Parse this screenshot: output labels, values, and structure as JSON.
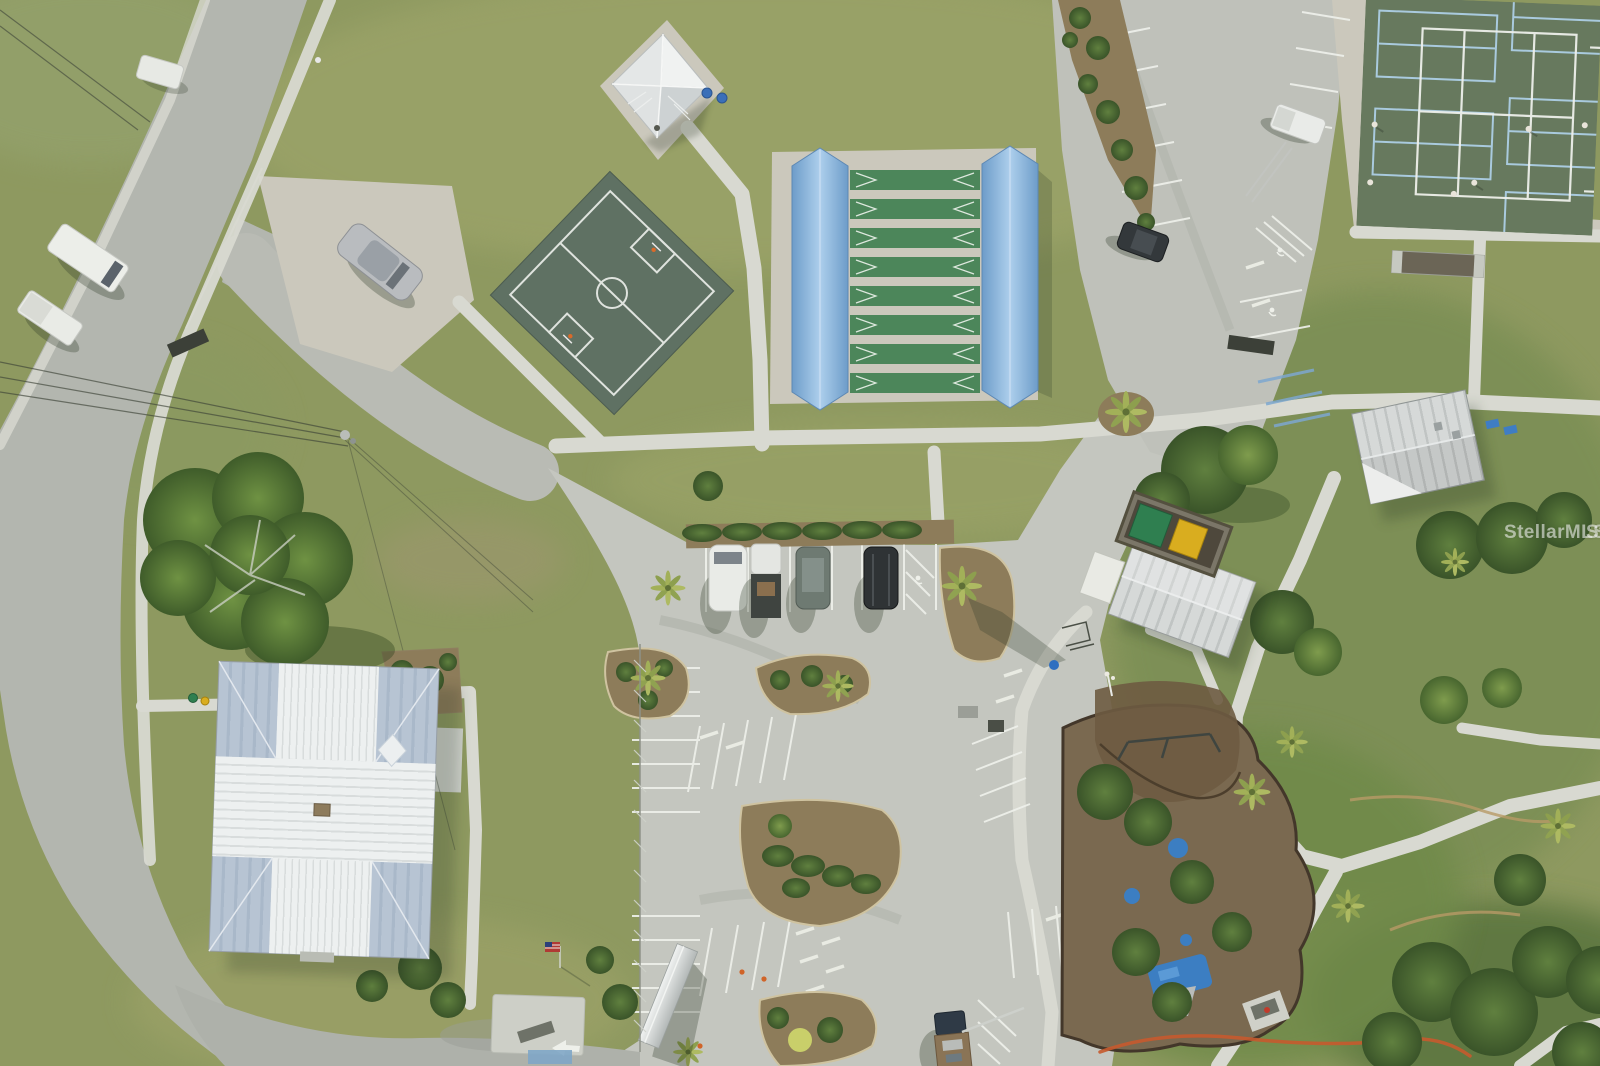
{
  "image": {
    "kind": "aerial-drone-photo",
    "subject": "community park campus with courts, parking and playground",
    "width_px": 1600,
    "height_px": 1066
  },
  "watermark": {
    "text": "StellarMLS"
  },
  "palette": {
    "grass-base": "#8e9960",
    "grass-light": "#9aa268",
    "grass-dark": "#7b8f54",
    "grass-deep": "#55713b",
    "road": "#b3b6af",
    "plaza": "#c4c6bf",
    "lot": "#bfc1ba",
    "walk": "#d8d9d1",
    "pad": "#cbc8bc",
    "white-line": "#eef0ea",
    "handicap-blue": "#7da7cf",
    "court-surface": "#5f7163",
    "court-line": "#dfe3de",
    "shuffle-green": "#4c865a",
    "canopy-blue": "#84aed6",
    "tennis-green": "#67795e",
    "tennis-blue-line": "#a9cade",
    "roof-white": "#e7eaea",
    "roof-blue-gray": "#b7c4d3",
    "roof-metal": "#c9cccb",
    "mulch": "#8d7c5a",
    "mulch-dark": "#6e5b41",
    "bush": "#4e6f3a",
    "tree-dark": "#466533",
    "palm": "#a8b75f",
    "dumpster-green": "#2f7f50",
    "dumpster-yellow": "#d9ad1f",
    "play-blue": "#3c7ec2",
    "safety-orange": "#c75a2e",
    "watermark-color": "rgba(255,255,255,0.55)"
  },
  "scene": {
    "features": [
      {
        "id": "public-road",
        "label": "public road with sidewalk, northwest corner"
      },
      {
        "id": "driveway-apron",
        "label": "roadside concrete apron with parked silver car"
      },
      {
        "id": "picnic-pavilion",
        "label": "square picnic pavilion, pyramidal metal roof"
      },
      {
        "id": "basketball-court",
        "label": "dark green basketball court set diagonally"
      },
      {
        "id": "shuffleboard-complex",
        "label": "eight shuffleboard courts between two light-blue canopies"
      },
      {
        "id": "tennis-pickleball-courts",
        "label": "tennis / pickleball courts with players, top right"
      },
      {
        "id": "north-parking-lot",
        "label": "striped parking lot, top right"
      },
      {
        "id": "community-building",
        "label": "community building with cross-shaped white metal roof"
      },
      {
        "id": "restroom-building",
        "label": "gable-roof park building"
      },
      {
        "id": "storage-shed",
        "label": "metal storage shed with porch pad"
      },
      {
        "id": "dumpster-enclosure",
        "label": "dumpster enclosure with green and yellow bins"
      },
      {
        "id": "central-parking",
        "label": "central parking plaza with landscaped islands"
      },
      {
        "id": "playground",
        "label": "playground with blue equipment on brown mulch"
      },
      {
        "id": "big-oak-tree",
        "label": "large spreading oak tree on lawn"
      },
      {
        "id": "palm-trees",
        "label": "cabbage palms along walks and islands"
      },
      {
        "id": "power-lines",
        "label": "overhead power lines with utility pole"
      },
      {
        "id": "orange-safety-fence",
        "label": "orange temporary safety fence near playground"
      },
      {
        "id": "us-flag",
        "label": "small United States flag near building"
      }
    ],
    "vehicles": [
      {
        "id": "silver-car",
        "color": "silver",
        "location": "driveway apron by road"
      },
      {
        "id": "white-van",
        "color": "white",
        "location": "west road shoulder"
      },
      {
        "id": "white-pickup",
        "color": "white",
        "location": "west road shoulder"
      },
      {
        "id": "white-suv",
        "color": "white",
        "location": "central parking row"
      },
      {
        "id": "white-truck-dark-bed",
        "color": "white cab, dark bed",
        "location": "central parking row"
      },
      {
        "id": "gray-suv",
        "color": "gray-green",
        "location": "central parking row"
      },
      {
        "id": "black-suv",
        "color": "black",
        "location": "central parking row"
      },
      {
        "id": "dark-suv",
        "color": "dark gray",
        "location": "north parking lot"
      },
      {
        "id": "white-utility-truck",
        "color": "white",
        "location": "north parking lot"
      },
      {
        "id": "flatbed-truck",
        "color": "dark cab, tan bed",
        "location": "south parking edge"
      }
    ],
    "counts": {
      "shuffleboard_courts": 8,
      "vehicles_center_row": 4,
      "tennis_players_visible": 6
    }
  }
}
